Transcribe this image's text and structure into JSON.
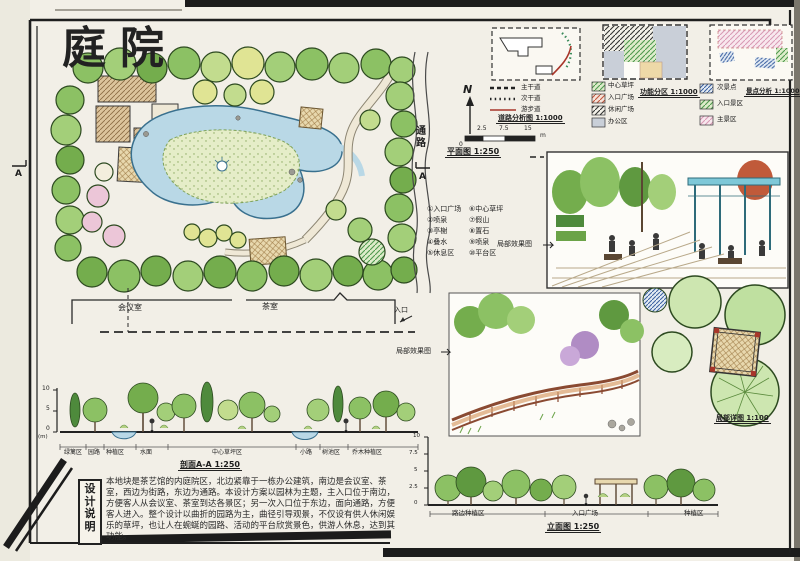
{
  "sheet": {
    "title": "庭院"
  },
  "plan": {
    "marker_a_left": "A",
    "marker_a_right": "A",
    "road_label": "通路",
    "north": "N",
    "caption": "平面图 1:250",
    "scale_bar": {
      "zero": "0",
      "t1": "2.5",
      "t2": "7.5",
      "t3": "15",
      "unit": "m"
    },
    "building": {
      "meeting_room": "会议室",
      "tea_room": "茶室",
      "entrance": "入口"
    },
    "legend_items": [
      "①入口广场",
      "②喷泉",
      "③亭榭",
      "④叠水",
      "⑤休息区",
      "⑥中心草坪",
      "⑦假山",
      "⑧置石",
      "⑨喷泉",
      "⑩平台区"
    ]
  },
  "analysis": {
    "road": {
      "caption": "道路分析图 1:1000",
      "items": [
        "主干道",
        "次干道",
        "游步道"
      ]
    },
    "function": {
      "caption": "功能分区 1:1000",
      "items": [
        "中心草坪",
        "入口广场",
        "休闲广场",
        "办公区"
      ]
    },
    "scenic": {
      "caption": "景点分析 1:1000",
      "items": [
        "次景点",
        "入口景区",
        "主景区"
      ]
    }
  },
  "effects": {
    "label_top": "局部效果图",
    "label_bottom": "局部效果图"
  },
  "section": {
    "caption": "剖面A-A 1:250",
    "scale": [
      "10",
      "5",
      "0"
    ],
    "unit": "(m)",
    "labels": [
      "绿篱区",
      "园路",
      "种植区",
      "水面",
      "中心草坪区",
      "小路",
      "树池区",
      "乔木种植区"
    ]
  },
  "elevation": {
    "caption": "立面图 1:250",
    "scale": [
      "10",
      "7.5",
      "5",
      "2.5",
      "0"
    ],
    "labels": [
      "路边种植区",
      "入口广场",
      "种植区"
    ]
  },
  "detail": {
    "caption": "局部详图 1:100"
  },
  "notes": {
    "title": "设计说明",
    "body": "本地块是茶艺馆的内庭院区，北边紧靠于一栋办公建筑，南边是会议室、茶室，西边为街路，东边为通路。本设计方案以园林为主题，主入口位于南边，方便客人从会议室、茶室到达各景区；另一次入口位于东边，面向通路，方便客人进入。整个设计以曲折的园路为主，曲径引导观景，不仅设有供人休闲娱乐的草坪，也让人在蜿蜒的园路、活动的平台欣赏景色，供游人休息，达到其功能。"
  },
  "colors": {
    "paper": "#f2efe7",
    "tree_green": "#8cc164",
    "water_blue": "#b9d8e6",
    "path_red": "#b5432e",
    "marker_black": "#1c1c1c"
  }
}
